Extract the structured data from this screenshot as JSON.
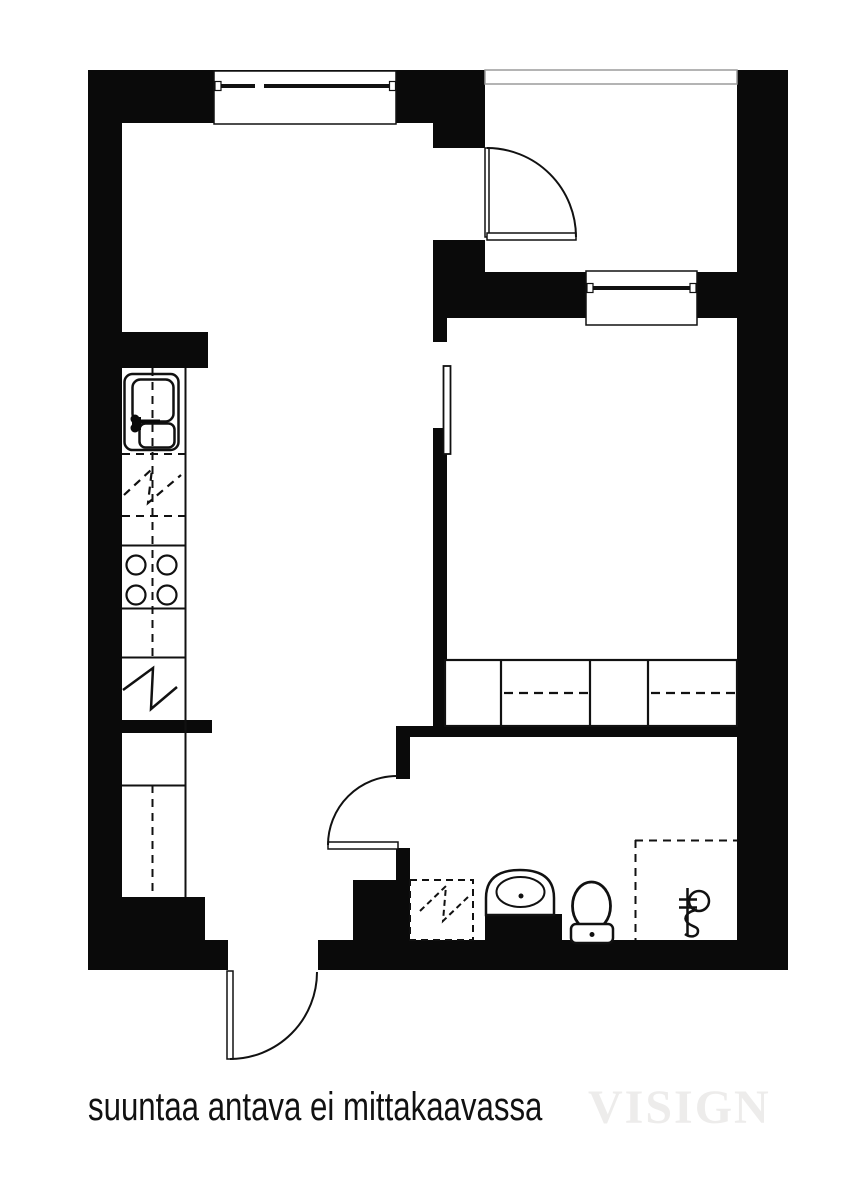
{
  "footer": {
    "note": "suuntaa antava ei mittakaavassa",
    "watermark": "VISIGN"
  },
  "colors": {
    "background": "#ffffff",
    "wall": "#0a0a0a",
    "line": "#111111",
    "railing_gray": "#9b9b9b",
    "note_text": "#111111",
    "watermark_gray": "#edeceb"
  },
  "plan": {
    "symbols": [
      "window",
      "door-swing",
      "sliding-door",
      "balcony-railing",
      "kitchen-sink",
      "dishwasher-reservation",
      "stove",
      "fridge",
      "wardrobe",
      "washing-machine-reservation",
      "washbasin",
      "toilet",
      "shower-area",
      "floor-drain"
    ]
  }
}
